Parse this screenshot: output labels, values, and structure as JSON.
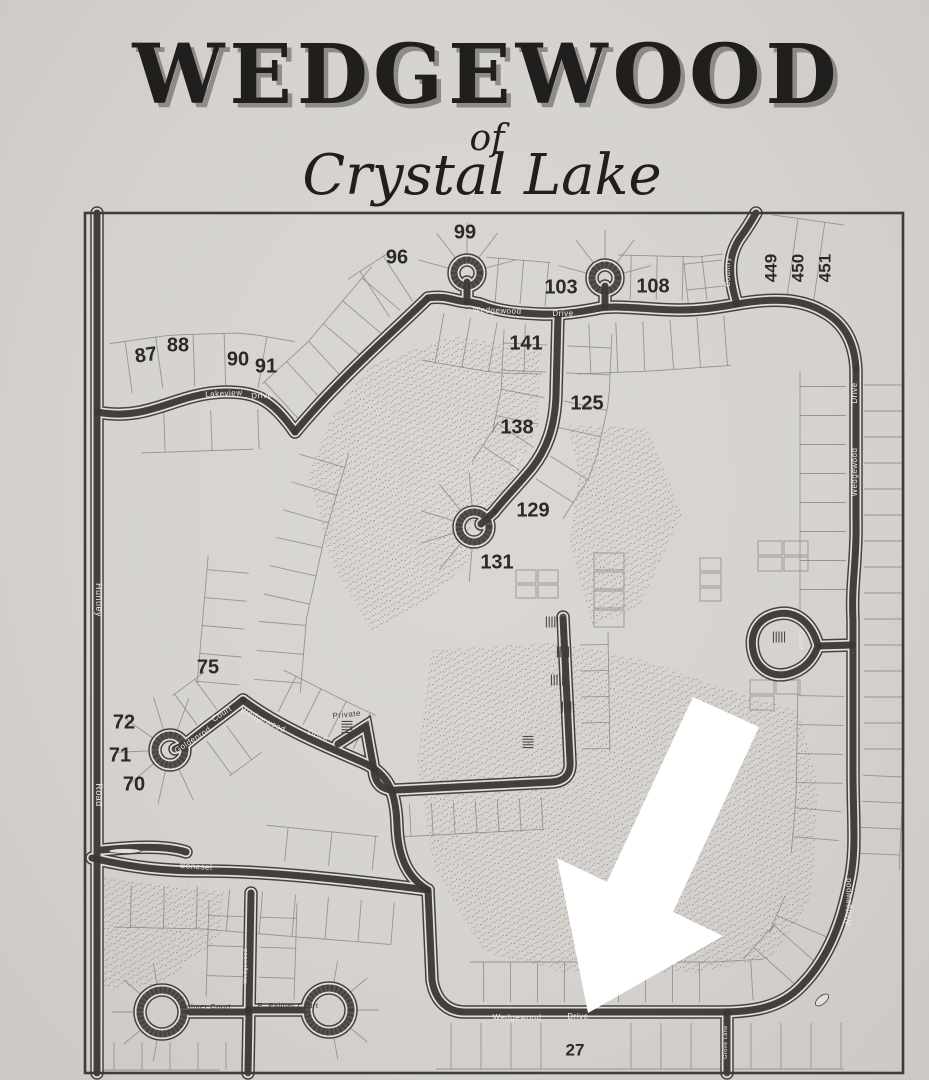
{
  "title": {
    "main": "WEDGEWOOD",
    "of": "of",
    "subtitle": "Crystal Lake"
  },
  "colors": {
    "paper": "#d7d4d0",
    "ink": "#1f1e1c",
    "border": "#3f3d3a",
    "road_edge": "#45433f",
    "road_casing": "#e2dfda",
    "road_fill": "#57544f",
    "road_texture": "#35332f",
    "parcel_line": "#8b8985",
    "stipple": "#6a6762",
    "lot_text": "#2b2a28",
    "street_text_light": "#edebe7",
    "street_text_dark": "#3b3a38",
    "arrow": "#ffffff"
  },
  "map": {
    "lots": [
      {
        "n": "99",
        "x": 465,
        "y": 233,
        "r": 0,
        "s": 20
      },
      {
        "n": "96",
        "x": 397,
        "y": 258,
        "r": 0,
        "s": 20
      },
      {
        "n": "103",
        "x": 561,
        "y": 288,
        "r": 0,
        "s": 20
      },
      {
        "n": "108",
        "x": 653,
        "y": 287,
        "r": 0,
        "s": 20
      },
      {
        "n": "449",
        "x": 772,
        "y": 268,
        "r": -90,
        "s": 17
      },
      {
        "n": "450",
        "x": 799,
        "y": 268,
        "r": -90,
        "s": 17
      },
      {
        "n": "451",
        "x": 826,
        "y": 268,
        "r": -90,
        "s": 17
      },
      {
        "n": "87",
        "x": 146,
        "y": 356,
        "r": -8,
        "s": 20
      },
      {
        "n": "88",
        "x": 178,
        "y": 346,
        "r": 0,
        "s": 20
      },
      {
        "n": "90",
        "x": 238,
        "y": 360,
        "r": 0,
        "s": 20
      },
      {
        "n": "91",
        "x": 266,
        "y": 367,
        "r": 0,
        "s": 20
      },
      {
        "n": "141",
        "x": 526,
        "y": 344,
        "r": 0,
        "s": 20
      },
      {
        "n": "125",
        "x": 587,
        "y": 404,
        "r": 0,
        "s": 20
      },
      {
        "n": "138",
        "x": 517,
        "y": 428,
        "r": 0,
        "s": 20
      },
      {
        "n": "129",
        "x": 533,
        "y": 511,
        "r": 0,
        "s": 20
      },
      {
        "n": "131",
        "x": 497,
        "y": 563,
        "r": 0,
        "s": 20
      },
      {
        "n": "75",
        "x": 208,
        "y": 668,
        "r": 0,
        "s": 20
      },
      {
        "n": "72",
        "x": 124,
        "y": 723,
        "r": 0,
        "s": 20
      },
      {
        "n": "71",
        "x": 120,
        "y": 756,
        "r": 0,
        "s": 20
      },
      {
        "n": "70",
        "x": 134,
        "y": 785,
        "r": 0,
        "s": 20
      },
      {
        "n": "27",
        "x": 575,
        "y": 1051,
        "r": 0,
        "s": 17
      }
    ],
    "streets": [
      {
        "t": "Huntley",
        "x": 96,
        "y": 600,
        "r": 90,
        "tone": "light",
        "s": 9
      },
      {
        "t": "Road",
        "x": 96,
        "y": 795,
        "r": 90,
        "tone": "light",
        "s": 9
      },
      {
        "t": "Lakeview",
        "x": 224,
        "y": 396,
        "r": -3,
        "tone": "light",
        "s": 8
      },
      {
        "t": "Drive",
        "x": 262,
        "y": 398,
        "r": -3,
        "tone": "light",
        "s": 8
      },
      {
        "t": "Wedgewood",
        "x": 497,
        "y": 313,
        "r": 2,
        "tone": "light",
        "s": 8
      },
      {
        "t": "Drive",
        "x": 563,
        "y": 316,
        "r": 0,
        "tone": "light",
        "s": 8
      },
      {
        "t": "Country",
        "x": 730,
        "y": 272,
        "r": -90,
        "tone": "light",
        "s": 7.5
      },
      {
        "t": "Drive",
        "x": 857,
        "y": 393,
        "r": -90,
        "tone": "light",
        "s": 8
      },
      {
        "t": "Wedgewood",
        "x": 857,
        "y": 472,
        "r": -90,
        "tone": "light",
        "s": 8
      },
      {
        "t": "Wedgewood",
        "x": 851,
        "y": 902,
        "r": -90,
        "tone": "light",
        "s": 8
      },
      {
        "t": "Goldenrod",
        "x": 194,
        "y": 742,
        "r": -33,
        "tone": "light",
        "s": 8
      },
      {
        "t": "Court",
        "x": 223,
        "y": 716,
        "r": -33,
        "tone": "light",
        "s": 8
      },
      {
        "t": "Wedgewood",
        "x": 262,
        "y": 722,
        "r": 25,
        "tone": "light",
        "s": 8
      },
      {
        "t": "Drive",
        "x": 317,
        "y": 738,
        "r": 22,
        "tone": "light",
        "s": 8
      },
      {
        "t": "Private",
        "x": 347,
        "y": 717,
        "r": -6,
        "tone": "dark",
        "s": 8
      },
      {
        "t": "Court",
        "x": 519,
        "y": 463,
        "r": -68,
        "tone": "light",
        "s": 7.5
      },
      {
        "t": "Court",
        "x": 799,
        "y": 640,
        "r": 90,
        "tone": "light",
        "s": 7
      },
      {
        "t": "Bonesel",
        "x": 196,
        "y": 869,
        "r": 4,
        "tone": "light",
        "s": 8
      },
      {
        "t": "Palmer Court",
        "x": 206,
        "y": 1009,
        "r": 0,
        "tone": "dark",
        "s": 7.5
      },
      {
        "t": "E. Palmer Court",
        "x": 288,
        "y": 1008,
        "r": 0,
        "tone": "dark",
        "s": 7.5
      },
      {
        "t": "Wedgewood",
        "x": 517,
        "y": 1020,
        "r": 0,
        "tone": "light",
        "s": 8
      },
      {
        "t": "Drive",
        "x": 578,
        "y": 1019,
        "r": 0,
        "tone": "light",
        "s": 8
      },
      {
        "t": "Grove Lane",
        "x": 727,
        "y": 1042,
        "r": -90,
        "tone": "light",
        "s": 5.5
      },
      {
        "t": "Wedgewood",
        "x": 247,
        "y": 966,
        "r": -90,
        "tone": "light",
        "s": 5.5
      }
    ]
  }
}
